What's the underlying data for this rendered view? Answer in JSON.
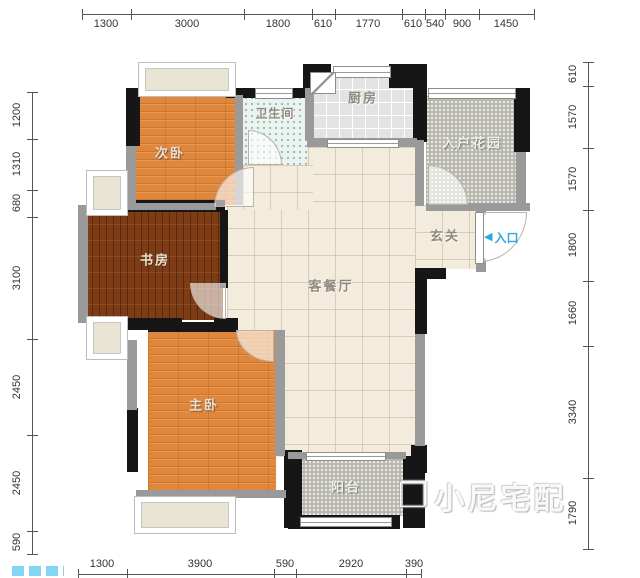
{
  "plan": {
    "rooms": {
      "secondary_bedroom": "次卧",
      "bathroom": "卫生间",
      "kitchen": "厨房",
      "entry_garden": "入户花园",
      "study": "书房",
      "living_dining": "客餐厅",
      "foyer": "玄关",
      "master_bedroom": "主卧",
      "balcony": "阳台"
    },
    "entrance": {
      "arrow": "◀",
      "label": "入口"
    }
  },
  "dimensions": {
    "top": [
      "1300",
      "3000",
      "1800",
      "610",
      "1770",
      "610",
      "540",
      "900",
      "1450"
    ],
    "left": [
      "1200",
      "1310",
      "680",
      "3100",
      "2450",
      "2450",
      "590"
    ],
    "right": [
      "610",
      "1570",
      "1570",
      "1800",
      "1660",
      "3340",
      "1790"
    ],
    "bottom": [
      "1300",
      "3900",
      "590",
      "2920",
      "390"
    ]
  },
  "watermark": {
    "logo": "❐",
    "text": "小尼宅配"
  },
  "colors": {
    "bedroom_floor": "#e0873c",
    "study_floor": "#7d3c16",
    "living_floor": "#f3ecdc",
    "bathroom_floor": "#eaf3ef",
    "kitchen_floor": "#e3e3e3",
    "outdoor_floor": "#b7b7af",
    "wall_black": "#161616",
    "wall_gray": "#9a9a9a",
    "entrance_blue": "#2ea7e0"
  }
}
